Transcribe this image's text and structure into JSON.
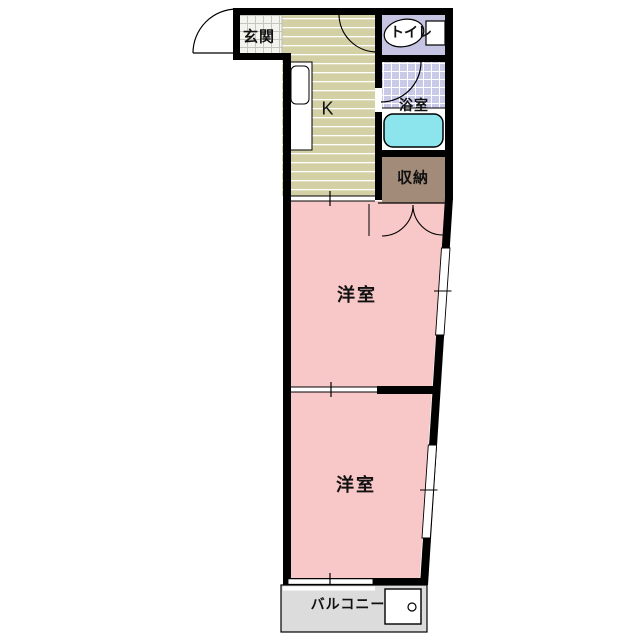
{
  "floorplan": {
    "type": "apartment-floorplan",
    "rooms": {
      "genkan": {
        "label": "玄関"
      },
      "toilet": {
        "label": "トイレ"
      },
      "kitchen": {
        "label": "K"
      },
      "bathroom": {
        "label": "浴室"
      },
      "storage": {
        "label": "収納"
      },
      "western_room_1": {
        "label": "洋室"
      },
      "western_room_2": {
        "label": "洋室"
      },
      "balcony": {
        "label": "バルコニー"
      }
    },
    "fixtures": {
      "toilet_icon": "toilet-bowl-with-tank",
      "bathtub_icon": "bathtub",
      "kitchen_counter_icon": "counter-with-sink",
      "washer_pan_icon": "washing-machine-pan-with-drain",
      "entrance_door_icon": "door-swing-arc",
      "closet_doors_icon": "double-door-swing-arcs"
    },
    "colors": {
      "wall": "#000000",
      "room_pink": "#f8c7c7",
      "kitchen_beige": "#d4d0a6",
      "toilet_lavender": "#c5c5e3",
      "bath_tile": "#c9c9e8",
      "tub_cyan": "#8ce4ec",
      "storage_brown": "#a38b79",
      "balcony_gray": "#dcdcdc",
      "genkan_tile": "#f4f4ef",
      "background": "#ffffff"
    }
  }
}
